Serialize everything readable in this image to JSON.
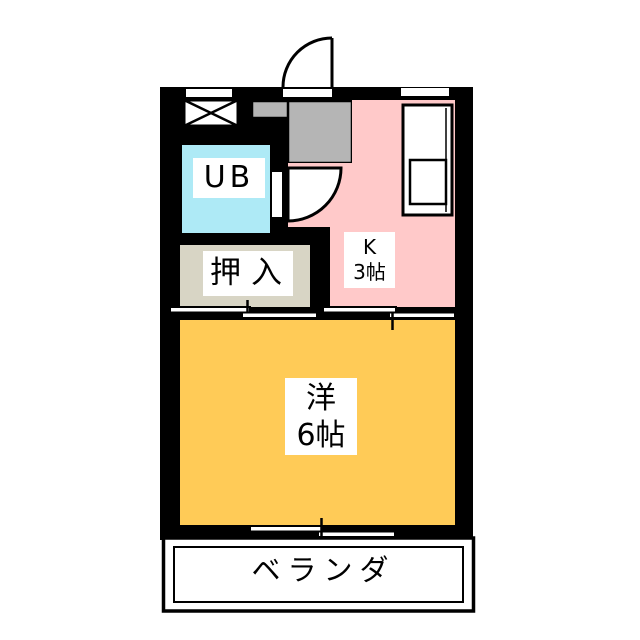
{
  "plan_title": "1K apartment floor plan",
  "rooms": {
    "unit_bath": {
      "label": "UB",
      "color": "#AEEAF6"
    },
    "closet": {
      "label": "押入",
      "color": "#D8D5C5"
    },
    "kitchen": {
      "name_line": "K",
      "size_line": "3帖",
      "color": "#FFC9C9"
    },
    "western_room": {
      "name_line": "洋",
      "size_line": "6帖",
      "color": "#FFCB57"
    },
    "veranda": {
      "label": "ベランダ"
    },
    "entrance_hall": {
      "color": "#B5B5B5"
    }
  },
  "colors": {
    "wall": "#000000",
    "canvas": "#FFFFFF",
    "fixture": "#FFFFFF"
  }
}
